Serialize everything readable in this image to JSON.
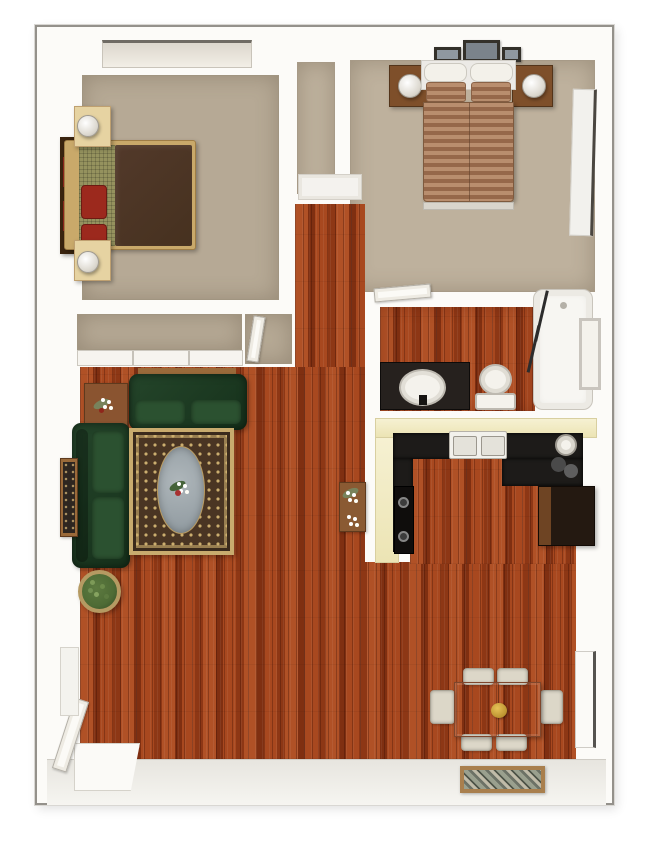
{
  "image": {
    "kind": "3d-floor-plan",
    "view": "top-down",
    "text_present": false
  },
  "colors": {
    "wall": "#fcfbf8",
    "border": "#94918b",
    "carpet": "#b6a995",
    "carpet_light": "#beb19d",
    "wood_base": "#a04420",
    "wood_light": "#b05126",
    "wood_mid": "#a8481f",
    "wood_dark": "#7f2f11",
    "sofa_green": "#16311b",
    "cushion_green": "#2b5130",
    "bed1_blanket": "#46311f",
    "pillow_red": "#9c291d",
    "bed_frame": "#c9a96a",
    "headboard": "#3a240f",
    "nightstand_light": "#e6d3a2",
    "nightstand_dark": "#7e4f2a",
    "stripe_light": "#b98e6e",
    "stripe_dark": "#96684a",
    "counter_cream": "#ece4b4",
    "counter_black": "#1d1b19",
    "fridge": "#241911",
    "fridge_side": "#6e4423",
    "rug_field": "#4a3523",
    "rug_gold": "#c8ab6e",
    "rug_center": "#8d979d",
    "table_wood": "#ad6847",
    "chair_cream": "#dcd7c8",
    "mat_frame": "#a97f4d",
    "plant_green": "#4e6b35",
    "basket": "#b59a62",
    "fixture_white": "#f4f2ec",
    "tile_white": "#fbfaf7"
  },
  "rooms": [
    {
      "name": "bedroom-left",
      "floor": "carpet",
      "items": [
        "bed-dark-blanket",
        "red-pillows",
        "headboard",
        "nightstand-top",
        "nightstand-bottom",
        "table-lamps",
        "window"
      ]
    },
    {
      "name": "bedroom-right",
      "floor": "carpet",
      "items": [
        "bed-striped-blanket",
        "white-pillows",
        "nightstand-left",
        "nightstand-right",
        "table-lamps",
        "wall-pictures",
        "door-panel"
      ]
    },
    {
      "name": "bathroom",
      "floor": "hardwood",
      "items": [
        "vanity-with-sink",
        "toilet",
        "bathtub",
        "shower-door-track",
        "window",
        "door"
      ]
    },
    {
      "name": "kitchen",
      "floor": "hardwood",
      "items": [
        "cream-counters",
        "black-countertop",
        "double-sink",
        "range-cooktop",
        "refrigerator",
        "coffee-maker",
        "round-appliance"
      ]
    },
    {
      "name": "living-room",
      "floor": "hardwood",
      "items": [
        "loveseat",
        "sofa",
        "area-rug",
        "end-table",
        "console-table",
        "sofa-table",
        "potted-plant",
        "flower-stand"
      ]
    },
    {
      "name": "dining-area",
      "floor": "hardwood",
      "items": [
        "dining-table",
        "dining-chairs",
        "gold-centerpiece",
        "decorative-door-mat",
        "entry-door",
        "wall-door-panel"
      ]
    },
    {
      "name": "hallway",
      "floor": "hardwood",
      "items": [
        "hall-closet-door"
      ]
    },
    {
      "name": "closet",
      "floor": "carpet",
      "items": [
        "sliding-doors",
        "bedroom-door"
      ]
    }
  ]
}
